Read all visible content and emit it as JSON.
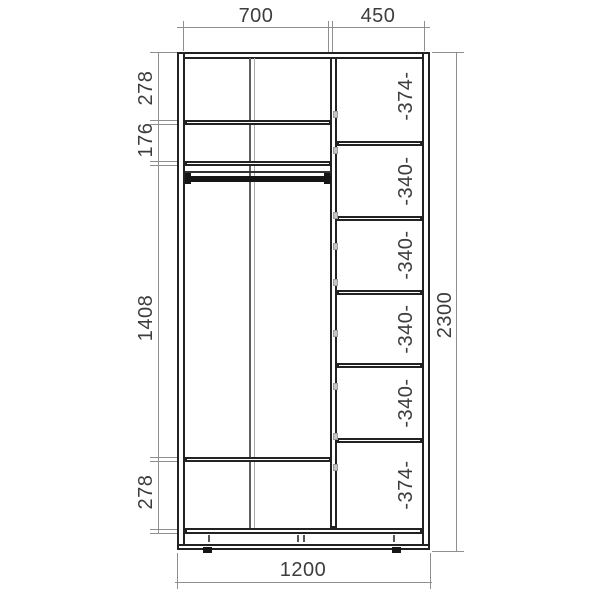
{
  "dimensions": {
    "top": [
      "700",
      "450"
    ],
    "left": [
      "278",
      "176",
      "1408",
      "278"
    ],
    "overall_height": "2300",
    "overall_width": "1200",
    "right_shelf_labels": [
      "-374-",
      "-340-",
      "-340-",
      "-340-",
      "-340-",
      "-374-"
    ]
  },
  "colors": {
    "drawing_line": "#222222",
    "dimension_line": "#8f8f8f",
    "label_text": "#3d3d3d",
    "background": "#ffffff"
  }
}
